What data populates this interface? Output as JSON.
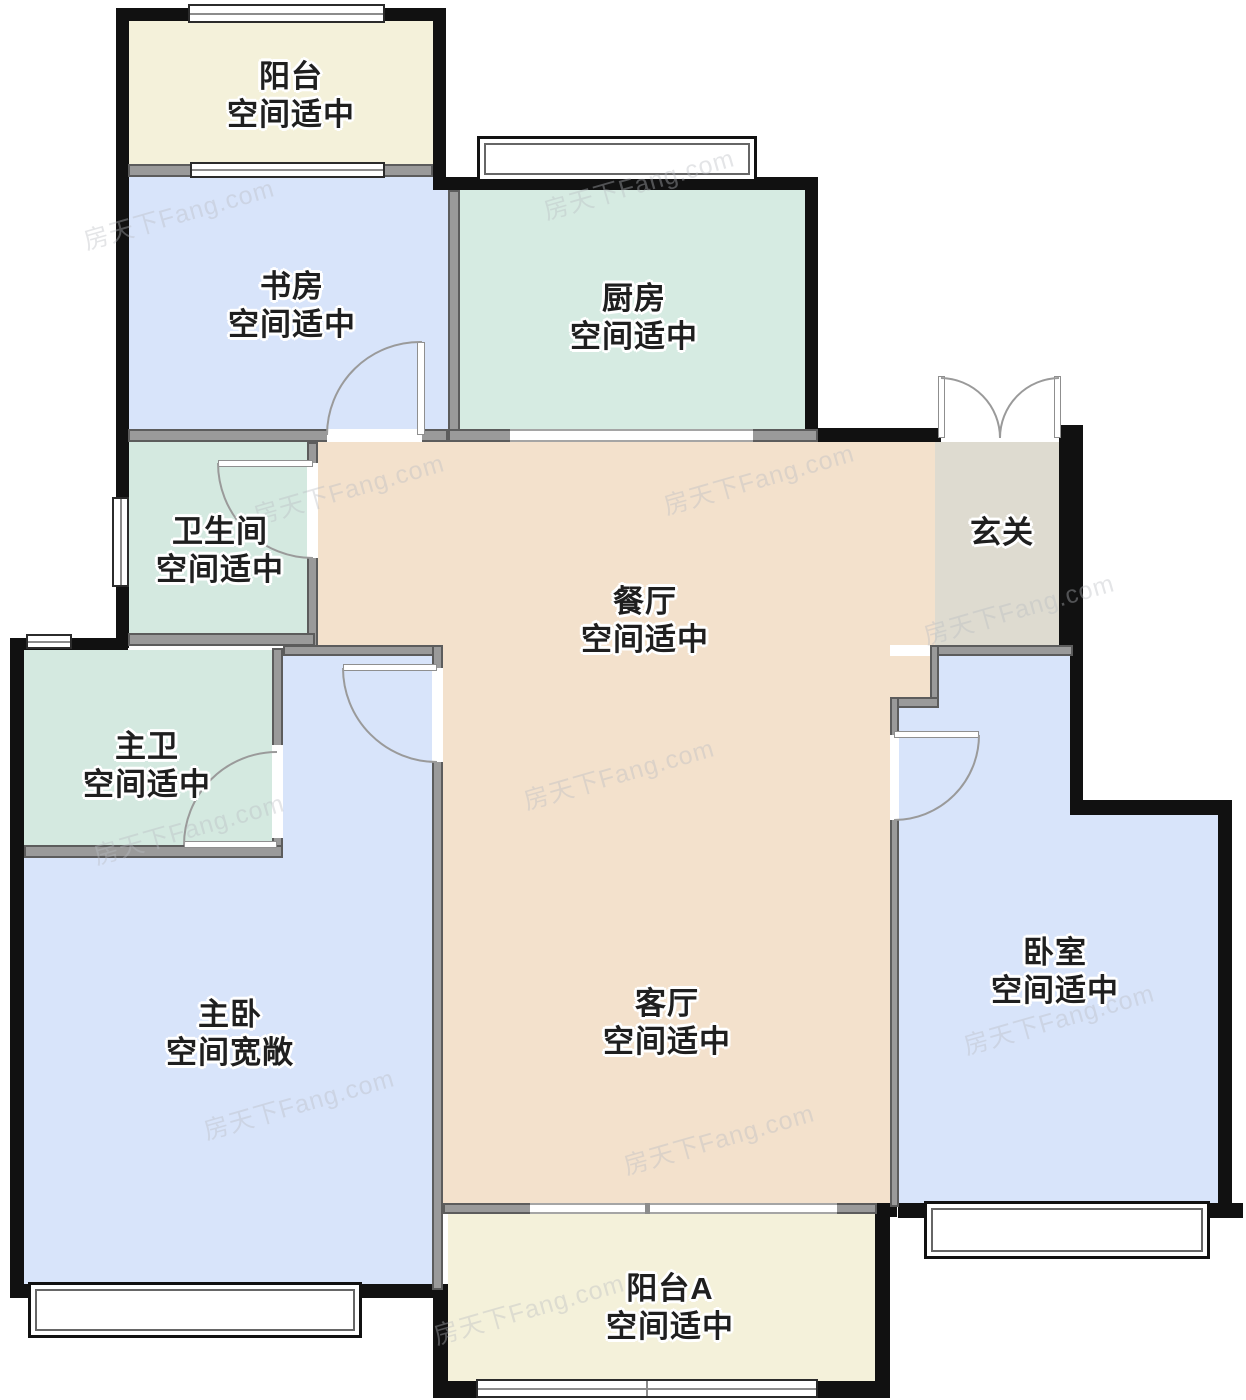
{
  "rooms": [
    {
      "id": "balcony-north",
      "name": "阳台",
      "status": "空间适中"
    },
    {
      "id": "study",
      "name": "书房",
      "status": "空间适中"
    },
    {
      "id": "kitchen",
      "name": "厨房",
      "status": "空间适中"
    },
    {
      "id": "bathroom",
      "name": "卫生间",
      "status": "空间适中"
    },
    {
      "id": "entry",
      "name": "玄关",
      "status": ""
    },
    {
      "id": "dining",
      "name": "餐厅",
      "status": "空间适中"
    },
    {
      "id": "master-bath",
      "name": "主卫",
      "status": "空间适中"
    },
    {
      "id": "master-bedroom",
      "name": "主卧",
      "status": "空间宽敞"
    },
    {
      "id": "living",
      "name": "客厅",
      "status": "空间适中"
    },
    {
      "id": "bedroom",
      "name": "卧室",
      "status": "空间适中"
    },
    {
      "id": "balcony-a",
      "name": "阳台A",
      "status": "空间适中"
    }
  ],
  "watermark": {
    "text": "房天下Fang.com"
  },
  "colors": {
    "balcony_cream": "#f4f1da",
    "bedroom_blue": "#d8e4fa",
    "kitchen_teal": "#d6ebe2",
    "bath_teal": "#d4e9e0",
    "hall_peach": "#f3e1cc",
    "entry_gray": "#dedbd0",
    "wall_exterior": "#111111",
    "wall_interior": "#9a9a9a",
    "text": "#1f1f1f"
  }
}
